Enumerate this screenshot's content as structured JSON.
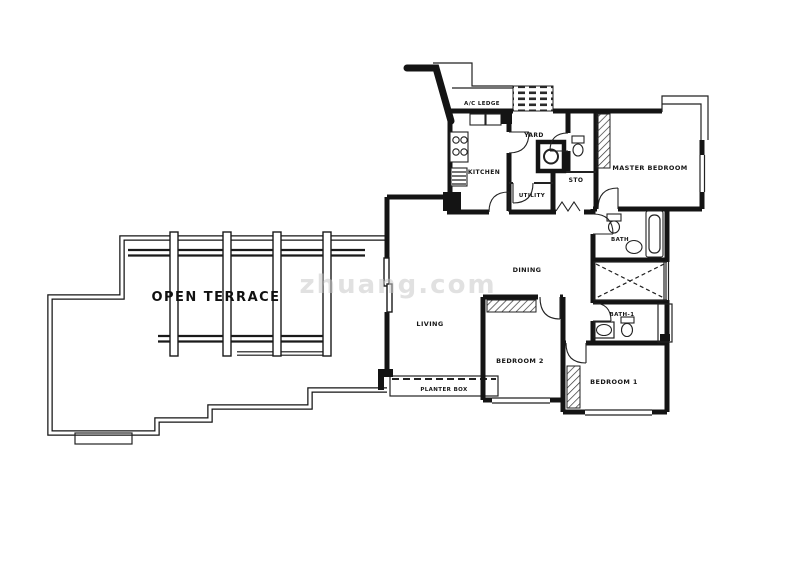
{
  "floor_plan": {
    "type": "apartment-floor-plan",
    "labels": {
      "open_terrace": "OPEN TERRACE",
      "ac_ledge": "A/C LEDGE",
      "kitchen": "KITCHEN",
      "yard": "YARD",
      "utility": "UTILITY",
      "sto": "STO",
      "master_bedroom": "MASTER BEDROOM",
      "bath": "BATH",
      "bath_1": "BATH-1",
      "dining": "DINING",
      "living": "LIVING",
      "bedroom_2": "BEDROOM 2",
      "bedroom_1": "BEDROOM 1",
      "planter_box": "PLANTER BOX"
    },
    "watermark": "zhuang.com",
    "colors": {
      "wall": "#141414",
      "background": "#ffffff",
      "watermark": "#c9c9c9"
    }
  }
}
